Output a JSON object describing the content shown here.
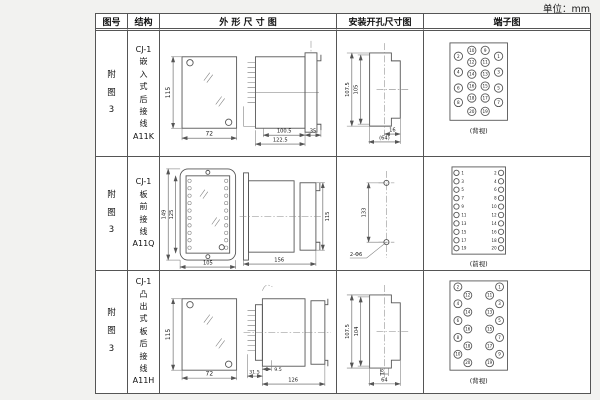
{
  "unit_label": "单位：mm",
  "colors": {
    "line": "#555555",
    "text": "#1a1a1a",
    "page_bg": "#f2f2f0",
    "paper": "#ffffff"
  },
  "table": {
    "headers": {
      "fig_no": "图号",
      "structure": "结构",
      "outline": "外 形 尺 寸 图",
      "install": "安装开孔尺寸图",
      "terminal": "端子图"
    },
    "rows": [
      {
        "fig_no": "附\n图\n3",
        "structure": "CJ-1\n嵌\n入\n式\n后\n接\n线\nA11K",
        "outline": {
          "front_height": "115",
          "front_width": "72",
          "depth": "100.5",
          "total_depth": "122.5",
          "flange_depth": "35"
        },
        "install": {
          "outer_height": "107.5",
          "inner_height": "105",
          "slot_width": "16",
          "opening_width": "(64)"
        },
        "terminal": {
          "view_label": "(背视)",
          "outer_left": [
            "2",
            "4",
            "6",
            "8"
          ],
          "mid_left": [
            "10",
            "12",
            "14",
            "16",
            "18",
            "20"
          ],
          "mid_right": [
            "9",
            "11",
            "13",
            "15",
            "17",
            "19"
          ],
          "outer_right": [
            "1",
            "3",
            "5",
            "7"
          ]
        }
      },
      {
        "fig_no": "附\n图\n3",
        "structure": "CJ-1\n板\n前\n接\n线\nA11Q",
        "outline": {
          "front_outer_height": "149",
          "front_inner_height": "125",
          "front_width": "105",
          "depth": "156",
          "rear_height": "115"
        },
        "install": {
          "hole_spacing": "133",
          "hole_label": "2-Φ6"
        },
        "terminal": {
          "view_label": "(前视)",
          "left": [
            "1",
            "3",
            "5",
            "7",
            "9",
            "11",
            "13",
            "15",
            "17",
            "19"
          ],
          "right": [
            "2",
            "4",
            "6",
            "8",
            "10",
            "12",
            "14",
            "16",
            "18",
            "20"
          ]
        }
      },
      {
        "fig_no": "附\n图\n3",
        "structure": "CJ-1\n凸\n出\n式\n板\n后\n接\n线\nA11H",
        "outline": {
          "front_height": "115",
          "front_width": "72",
          "base_depth": "31.5",
          "plate_depth": "9.5",
          "depth": "126"
        },
        "install": {
          "outer_height": "107.5",
          "inner_height": "104",
          "slot_width": "16",
          "opening_width": "64"
        },
        "terminal": {
          "view_label": "(背视)",
          "outer_left": [
            "2",
            "4",
            "6",
            "8",
            "10"
          ],
          "inner_left": [
            "12",
            "14",
            "16",
            "18",
            "20"
          ],
          "inner_right": [
            "11",
            "13",
            "15",
            "17",
            "19"
          ],
          "outer_right": [
            "1",
            "3",
            "5",
            "7",
            "9"
          ]
        }
      }
    ]
  }
}
